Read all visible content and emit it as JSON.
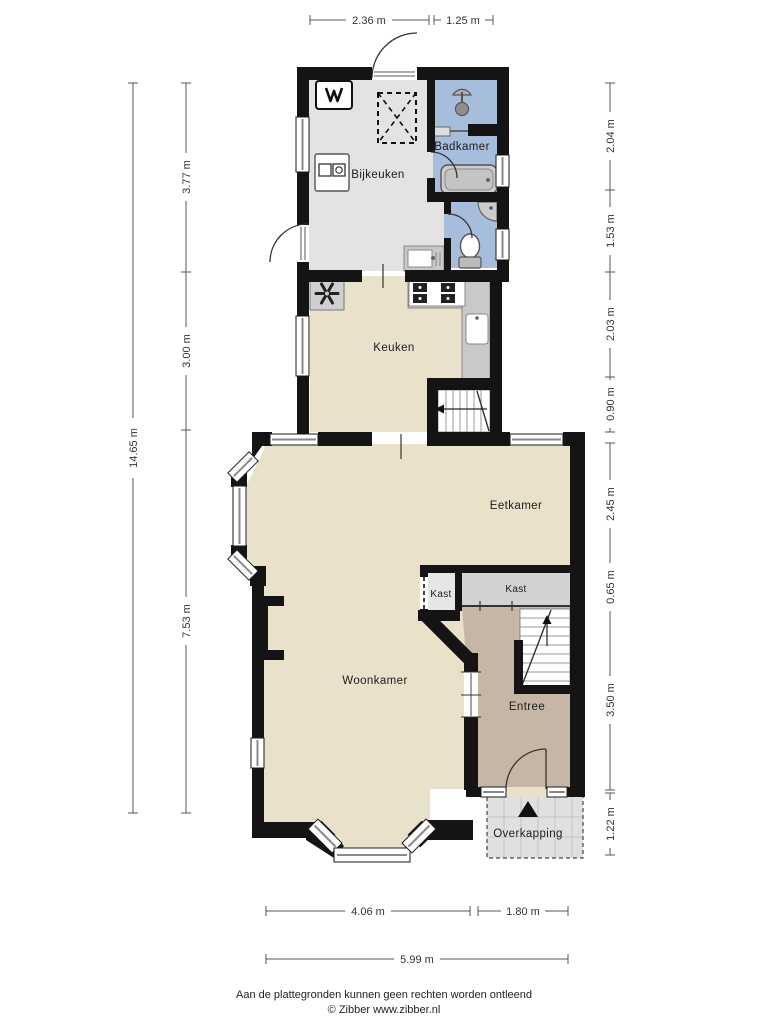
{
  "rooms": {
    "bijkeuken": "Bijkeuken",
    "badkamer": "Badkamer",
    "keuken": "Keuken",
    "eetkamer": "Eetkamer",
    "woonkamer": "Woonkamer",
    "kast_left": "Kast",
    "kast_right": "Kast",
    "entree": "Entree",
    "overkapping": "Overkapping"
  },
  "dimensions": {
    "top": [
      {
        "label": "2.36 m"
      },
      {
        "label": "1.25 m"
      }
    ],
    "left_outer": {
      "label": "14.65 m"
    },
    "left_inner": [
      {
        "label": "3.77 m"
      },
      {
        "label": "3.00 m"
      },
      {
        "label": "7.53 m"
      }
    ],
    "right": [
      {
        "label": "2.04 m"
      },
      {
        "label": "1.53 m"
      },
      {
        "label": "2.03 m"
      },
      {
        "label": "0.90 m"
      },
      {
        "label": "2.45 m"
      },
      {
        "label": "0.65 m"
      },
      {
        "label": "3.50 m"
      },
      {
        "label": "1.22 m"
      }
    ],
    "bottom": [
      {
        "label": "4.06 m"
      },
      {
        "label": "1.80 m"
      },
      {
        "label": "5.99 m"
      }
    ]
  },
  "footer": {
    "disclaimer": "Aan de plattegronden kunnen geen rechten worden ontleend",
    "credit": "© Zibber www.zibber.nl"
  },
  "colors": {
    "wall": "#141414",
    "floor_living": "#e9e1c9",
    "floor_utility": "#e3e3e3",
    "floor_bath": "#a6bddb",
    "floor_entree": "#c6b6a6",
    "floor_closet_left": "#e6e6e6",
    "floor_closet_right": "#d2d2d2",
    "counter": "#c9c9c9",
    "overkapping": "#e0e0e0"
  },
  "icons": {
    "boiler": "boiler-icon",
    "washer": "washer-icon",
    "skylight": "skylight-dashed-icon",
    "vent": "ventilation-fan-icon",
    "stove": "stove-icon",
    "shower": "shower-icon",
    "bathtub": "bathtub-icon",
    "toilet": "toilet-icon",
    "north_arrow": "north-arrow-icon"
  }
}
